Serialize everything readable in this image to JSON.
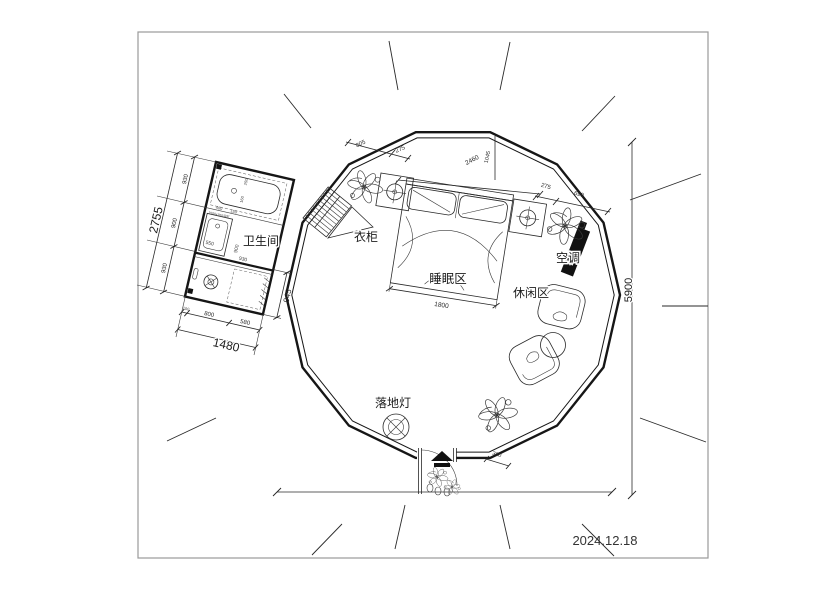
{
  "meta": {
    "date": "2024.12.18"
  },
  "labels": {
    "bathroom": "卫生间",
    "wardrobe": "衣柜",
    "sleeping_area": "睡眠区",
    "leisure_area": "休闲区",
    "air_conditioner": "空调",
    "floor_lamp": "落地灯"
  },
  "dims": {
    "d805": "805",
    "d275a": "275",
    "d2460": "2460",
    "d1045": "1045",
    "d275b": "275",
    "d690": "690",
    "d5900": "5900",
    "d1800": "1800",
    "d360": "360",
    "d2755": "2755",
    "d930a": "930",
    "d900a": "900",
    "d930b": "930",
    "d1480": "1480",
    "d100": "100",
    "d800": "800",
    "d580": "580",
    "d945": "945",
    "d400": "400",
    "d150": "150",
    "d250": "250",
    "d160": "160",
    "d550": "550",
    "d900b": "900",
    "d930c": "930",
    "tub_note": "1500x700浴缸"
  },
  "colors": {
    "line": "#2a2a2a",
    "wall": "#161616",
    "paper": "#ffffff",
    "solid_fill": "#111111"
  }
}
